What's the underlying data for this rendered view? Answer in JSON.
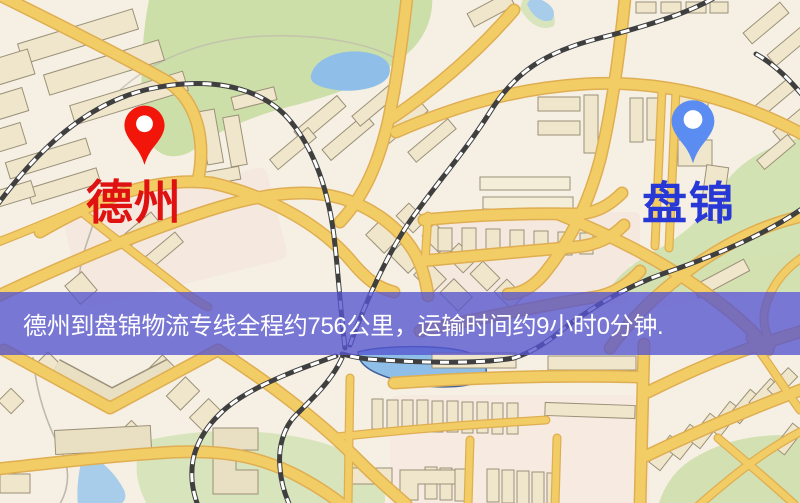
{
  "map": {
    "origin": {
      "name": "德州",
      "label_color": "#e01111",
      "pin_color": "#f2150a"
    },
    "destination": {
      "name": "盘锦",
      "label_color": "#2838d6",
      "pin_color": "#5b8cf2"
    },
    "banner": {
      "text": "德州到盘锦物流专线全程约756公里，运输时间约9小时0分钟.",
      "background_color": "#5655d0",
      "text_color": "#ffffff"
    },
    "route": {
      "from": "德州",
      "to": "盘锦",
      "distance_km": 756,
      "duration_text": "9小时0分钟"
    },
    "palette": {
      "land": "#f6f0e4",
      "road": "#f2cd66",
      "road_casing": "#dfae52",
      "building": "#efe6cb",
      "green_area": "#cddfa9",
      "water": "#8fbfe8",
      "railway": "#3f3f3f"
    }
  }
}
